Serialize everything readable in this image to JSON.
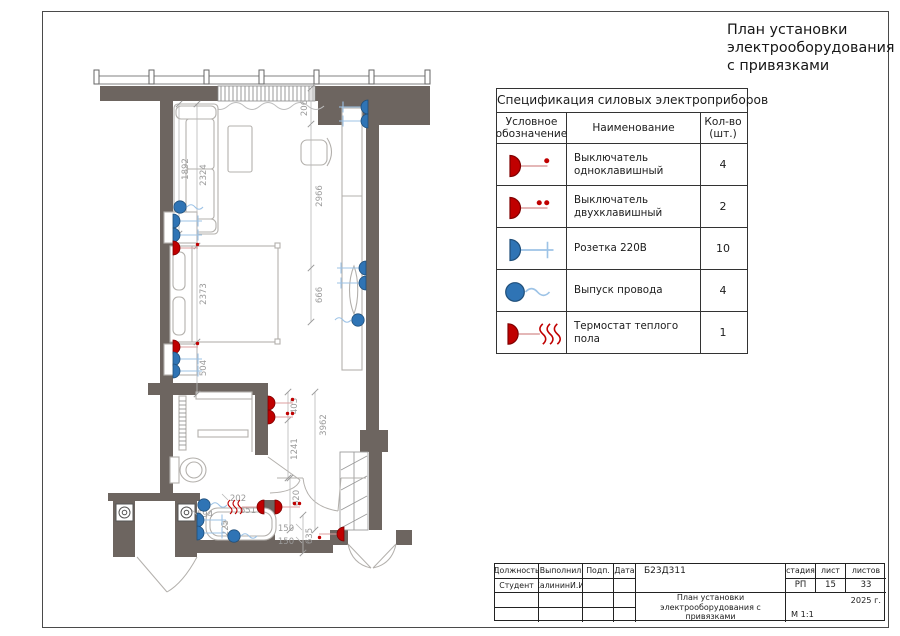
{
  "page": {
    "title_lines": [
      "План установки",
      "электрооборудования",
      "с привязками"
    ]
  },
  "spec_table": {
    "title": "Спецификация силовых электроприборов",
    "columns": [
      "Условное обозначение",
      "Наименование",
      "Кол-во (шт.)"
    ],
    "rows": [
      {
        "symbol": "switch-one-key",
        "name": "Выключатель одноклавишный",
        "qty": "4"
      },
      {
        "symbol": "switch-two-key",
        "name": "Выключатель двухклавишный",
        "qty": "2"
      },
      {
        "symbol": "socket-220v",
        "name": "Розетка 220В",
        "qty": "10"
      },
      {
        "symbol": "wire-outlet",
        "name": "Выпуск провода",
        "qty": "4"
      },
      {
        "symbol": "floor-thermostat",
        "name": "Термостат теплого пола",
        "qty": "1"
      }
    ]
  },
  "stamp": {
    "position_label": "Должность",
    "performed_label": "Выполнил",
    "sign_label": "Подп.",
    "date_label": "Дата",
    "doc_code": "Б23Д311",
    "position_value": "Студент",
    "performed_value": "КалининИ.И.",
    "stage_label": "стадия",
    "sheet_label": "лист",
    "sheets_label": "листов",
    "stage_value": "РП",
    "sheet_value": "15",
    "sheets_value": "33",
    "drawing_title": "План установки электрооборудования с привязками",
    "year": "2025 г.",
    "scale": "М 1:1"
  },
  "plan": {
    "colors": {
      "wall": "#6d6560",
      "symbol_blue": "#2f74b5",
      "symbol_red": "#c00000",
      "dim_text": "#9b9b9b"
    },
    "dims": [
      "1892",
      "2324",
      "2373",
      "504",
      "206",
      "2966",
      "666",
      "403",
      "1241",
      "3962",
      "620",
      "635",
      "150",
      "150",
      "202",
      "651",
      "594",
      "225"
    ]
  }
}
